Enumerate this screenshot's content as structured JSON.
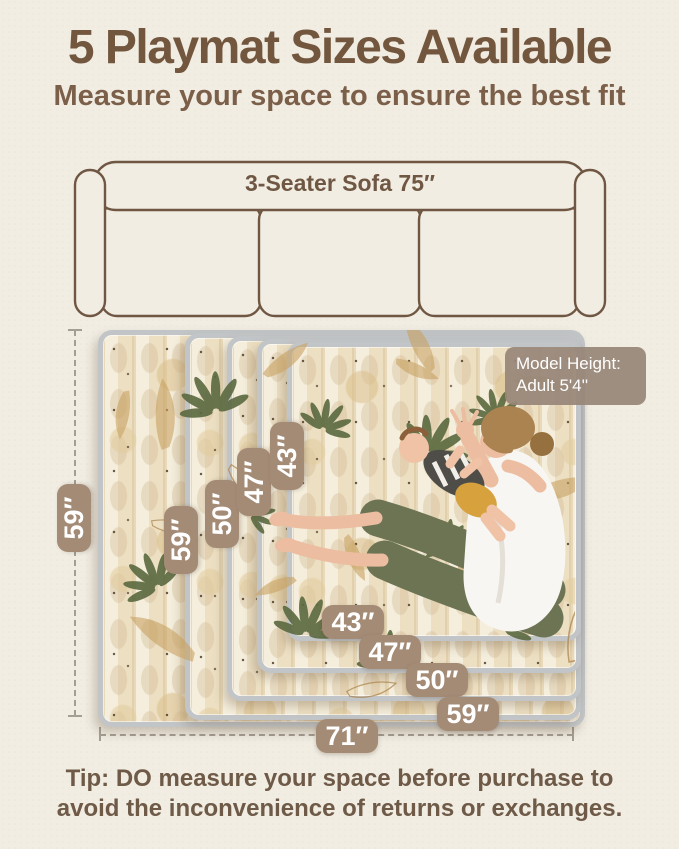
{
  "header": {
    "title": "5 Playmat Sizes Available",
    "subtitle": "Measure your space to ensure the best fit"
  },
  "sofa": {
    "label": "3-Seater Sofa 75″"
  },
  "diagram": {
    "outer_height_label": "59″",
    "outer_width_label": "71″",
    "vertical_labels": [
      "59″",
      "50″",
      "47″",
      "43″"
    ],
    "bottom_labels": [
      "43″",
      "47″",
      "50″",
      "59″"
    ],
    "model_badge": {
      "line1": "Model Height:",
      "line2": "Adult  5'4''"
    }
  },
  "tip": {
    "text": "Tip: DO measure your space before purchase to avoid the inconvenience of returns or exchanges."
  },
  "colors": {
    "background": "#f1ede3",
    "title_text": "#73563e",
    "subtitle_text": "#7b5f49",
    "sofa_line": "#6f5743",
    "badge_background": "#a48b76",
    "badge_text": "#ffffff",
    "dash_line": "#a59e92",
    "mat_binding_edge": "#c2c5c7",
    "mat_base": "#efe5d0",
    "leaf_green": "#5c6a41",
    "leaf_tan": "#c9a263",
    "tip_text": "#6e5a47"
  }
}
